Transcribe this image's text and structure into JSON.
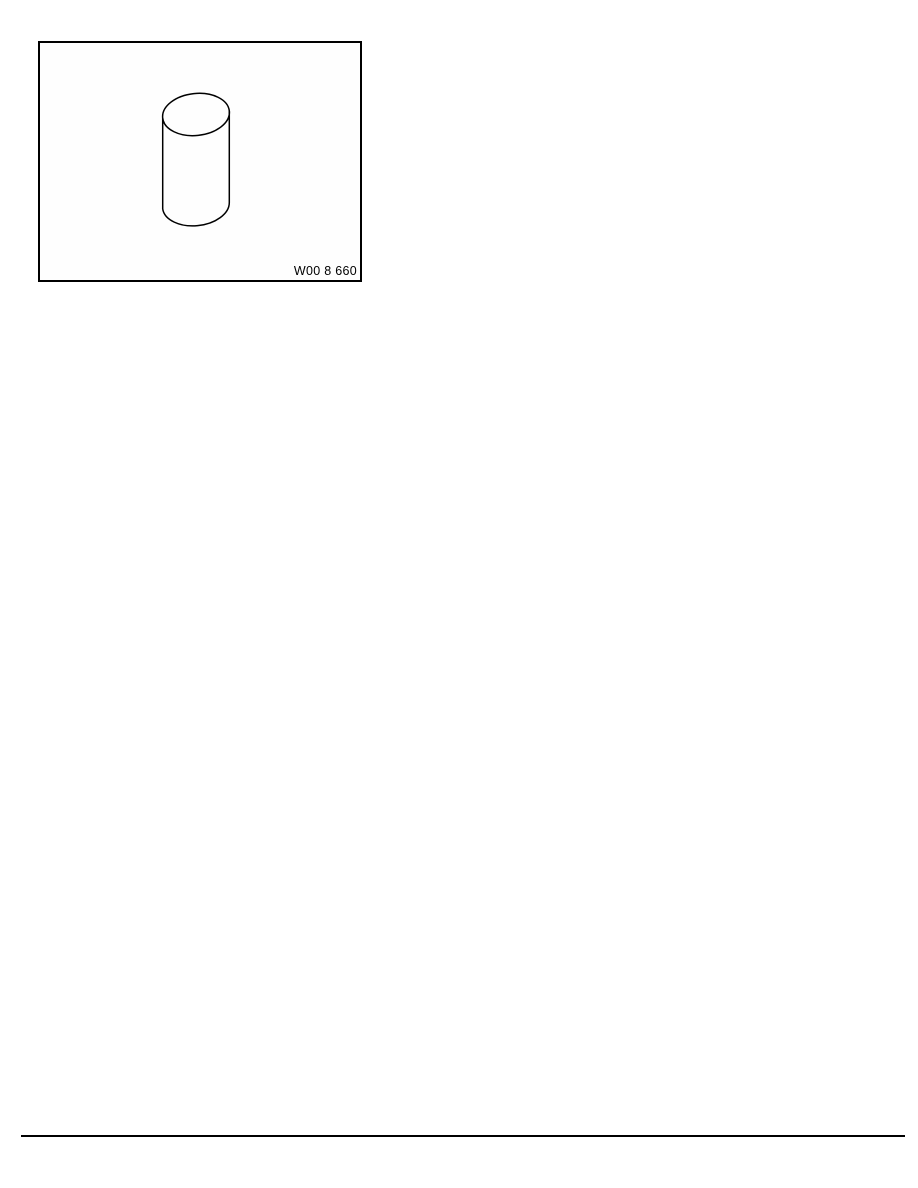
{
  "page": {
    "background": "#ffffff"
  },
  "figure": {
    "label": "W00 8 660",
    "drawing": "cylinder-line-drawing",
    "border_color": "#000000"
  },
  "divider": {
    "color": "#000000"
  }
}
